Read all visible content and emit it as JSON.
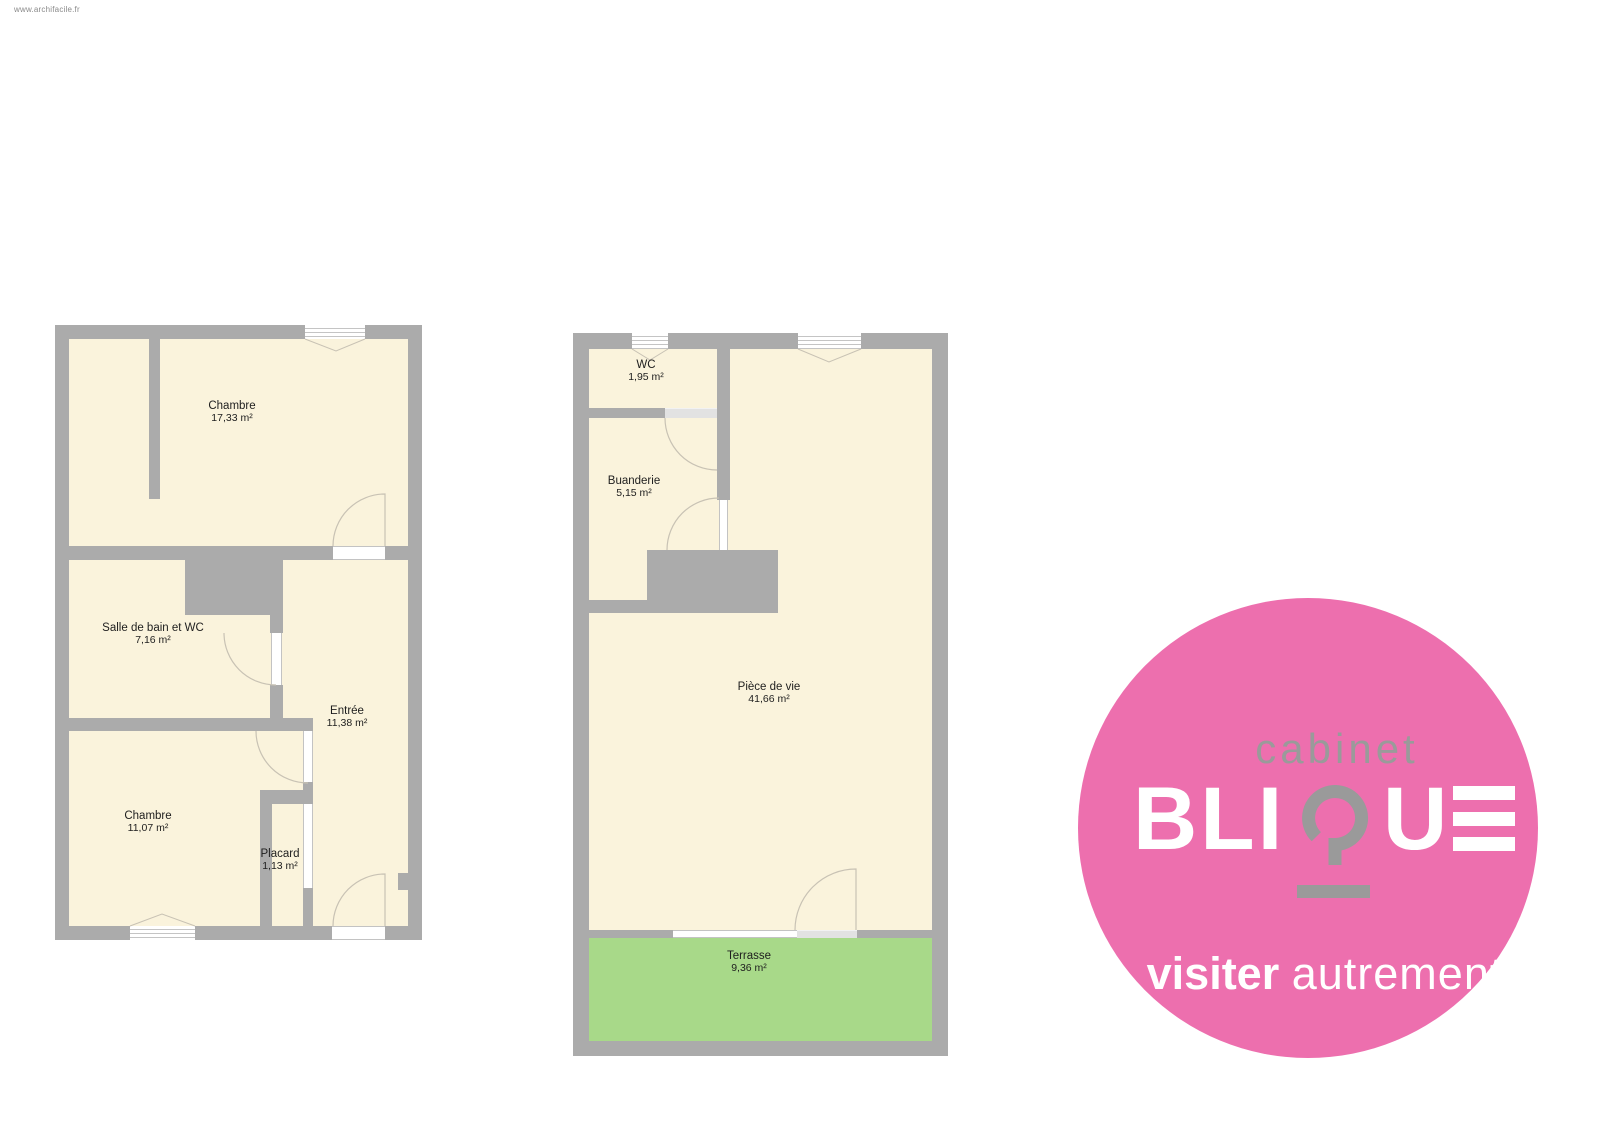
{
  "watermark": "www.archifacile.fr",
  "colors": {
    "wall": "#ababab",
    "floor": "#faf3dc",
    "terrace": "#a8d989",
    "brand_pink": "#ed6fae",
    "brand_gray": "#9a9a9a"
  },
  "plan1": {
    "rooms": {
      "chambre1": {
        "name": "Chambre",
        "area": "17,33 m²"
      },
      "salle_de_bain": {
        "name": "Salle de bain et WC",
        "area": "7,16 m²"
      },
      "entree": {
        "name": "Entrée",
        "area": "11,38 m²"
      },
      "chambre2": {
        "name": "Chambre",
        "area": "11,07 m²"
      },
      "placard": {
        "name": "Placard",
        "area": "1,13 m²"
      }
    }
  },
  "plan2": {
    "rooms": {
      "wc": {
        "name": "WC",
        "area": "1,95 m²"
      },
      "buanderie": {
        "name": "Buanderie",
        "area": "5,15 m²"
      },
      "piece_de_vie": {
        "name": "Pièce de vie",
        "area": "41,66 m²"
      },
      "terrasse": {
        "name": "Terrasse",
        "area": "9,36 m²"
      }
    }
  },
  "logo": {
    "top_word": "cabinet",
    "wordmark": "BLIQUE",
    "wordmark_parts": {
      "left": "BLI",
      "u": "U",
      "e": "E"
    },
    "tagline_bold": "visiter",
    "tagline_light": "autrement"
  }
}
